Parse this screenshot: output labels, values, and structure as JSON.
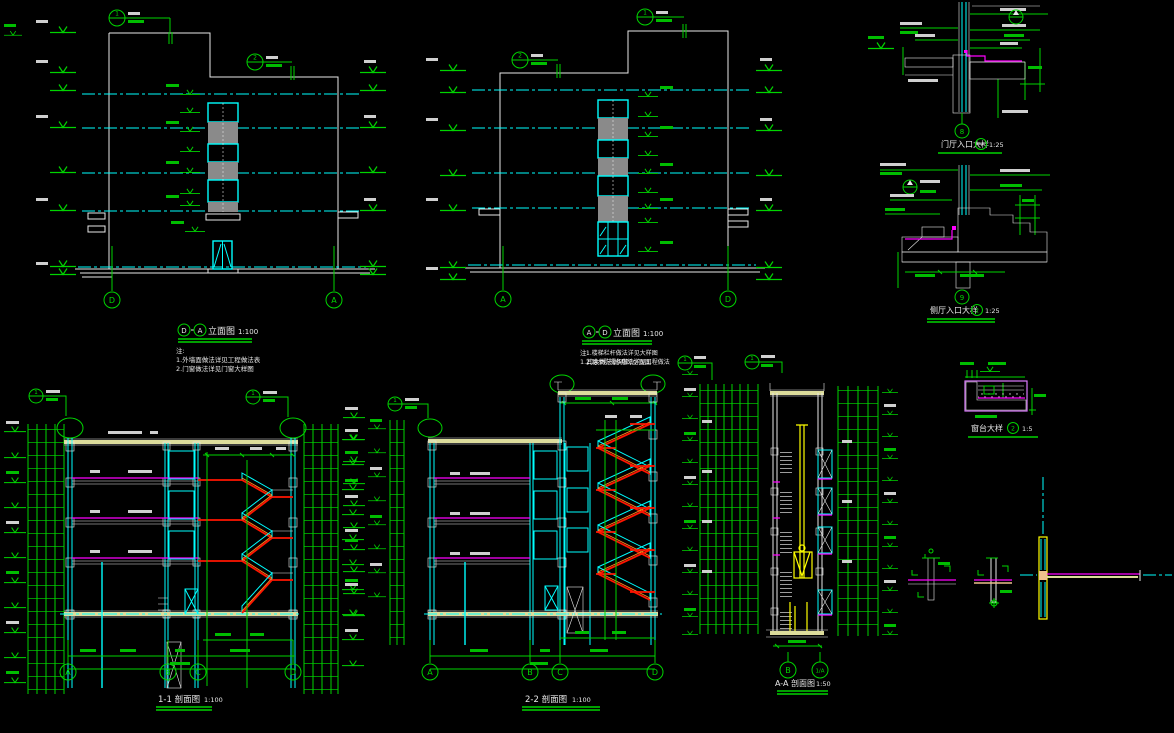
{
  "canvas": {
    "background": "#000000"
  },
  "colors": {
    "green": "#00d400",
    "cyan": "#00ffff",
    "white": "#e8e8e8",
    "magenta": "#ff00ff",
    "red": "#ff1400",
    "orange": "#ff8a1e",
    "yellow": "#ffff00",
    "beam_khaki": "#dcdc9b",
    "wood_peach": "#eec08c",
    "spandrel_gray": "#8a8a8a",
    "violet": "#dd7bff"
  },
  "views": {
    "elevation_da": {
      "bubble_left": "D",
      "bubble_right": "A",
      "title": "立面图",
      "scale": "1:100",
      "notes": [
        "注:",
        "1.外墙面做法详见工程做法表",
        "2.门窗做法详见门窗大样图"
      ],
      "callout_1": "1",
      "callout_2": "2"
    },
    "elevation_ad": {
      "bubble_left": "A",
      "bubble_right": "D",
      "title": "立面图",
      "scale": "1:100",
      "notes": [
        "注:",
        "1.其余做法说明同立面图"
      ],
      "callout_1": "1",
      "callout_2": "2"
    },
    "section_11": {
      "title": "1-1 剖面图",
      "scale": "1:100",
      "grid_bubbles": [
        "A",
        "B",
        "C",
        "D"
      ],
      "callout_1": "1",
      "callout_2": "1"
    },
    "section_22": {
      "title": "2-2 剖面图",
      "scale": "1:100",
      "grid_bubbles": [
        "A",
        "B",
        "C",
        "D"
      ],
      "notes": [
        "1.楼梯栏杆做法详见大样图",
        "2.踏步防滑条做法详见工程做法"
      ],
      "callout_1": "1"
    },
    "section_aa": {
      "title": "A-A 剖面图",
      "scale": "1:50",
      "grid_bubbles": [
        "B",
        "1/A"
      ],
      "callout_1": "1",
      "callout_2": "1"
    },
    "detail_1": {
      "title": "门厅入口大样",
      "scale": "1:25",
      "symbol": "—",
      "grid_bubble": "8"
    },
    "detail_2": {
      "title": "侧厅入口大样",
      "scale": "1:25",
      "symbol": "2",
      "grid_bubble": "9"
    },
    "detail_3": {
      "title": "窗台大样",
      "scale": "1:5",
      "symbol": "2"
    }
  }
}
